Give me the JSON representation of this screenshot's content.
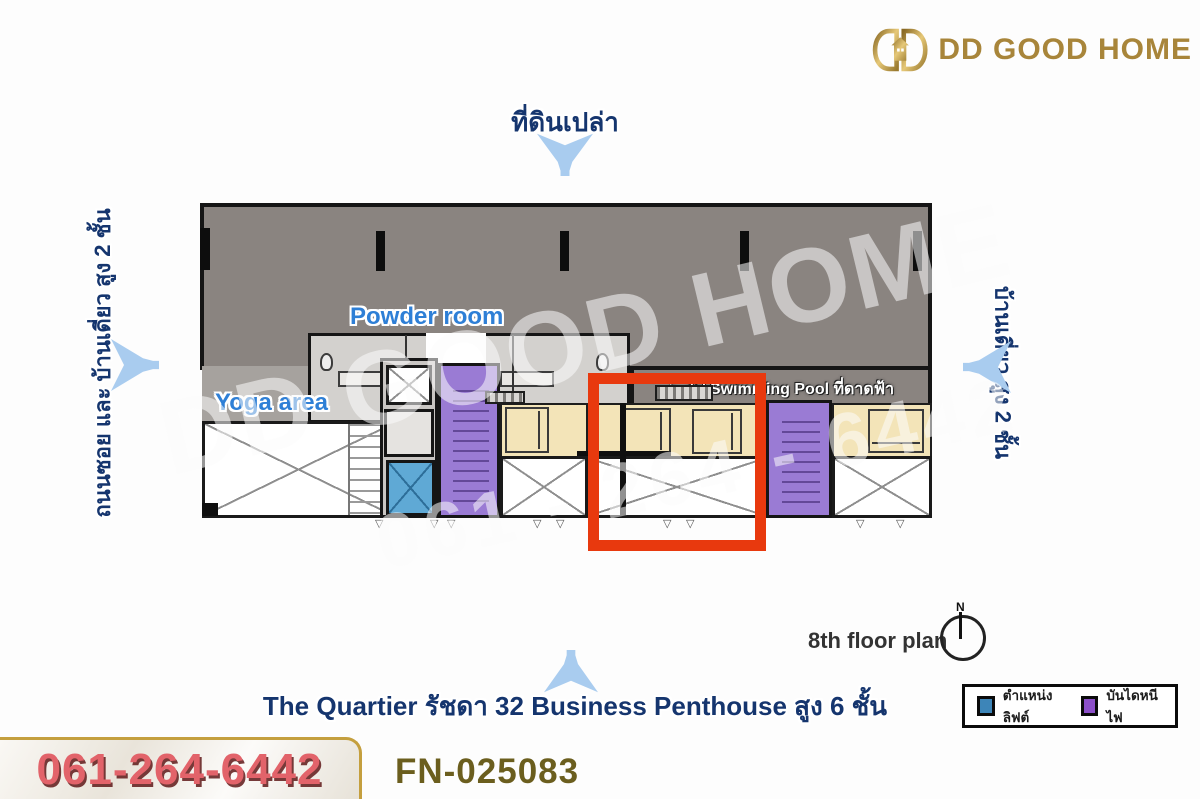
{
  "brand": {
    "name": "DD GOOD HOME"
  },
  "surroundings": {
    "top_label": "ที่ดินเปล่า",
    "left_label": "ถนนซอย และ บ้านเดี่ยว สูง 2 ชั้น",
    "right_label": "บ้านเดี่ยว สูง 2 ชั้น"
  },
  "plan": {
    "powder_room_label": "Powder room",
    "yoga_area_label": "Yoga area",
    "pool_label": "ไป Swimming Pool ที่ดาดฟ้า",
    "pool_arrow_glyph": "➤",
    "floor_plan_label": "8th floor plan",
    "compass_north_label": "N",
    "door_mark_glyph": "▽"
  },
  "watermark": {
    "line1": "DD GOOD HOME",
    "line2": "061 - 264 - 6442"
  },
  "project_title": "The Quartier รัชดา 32 Business Penthouse สูง 6 ชั้น",
  "legend": {
    "items": [
      {
        "label": "ตำแหน่งลิฟต์",
        "color": "#3d85b8"
      },
      {
        "label": "บันไดหนีไฟ",
        "color": "#8c4fc9"
      }
    ]
  },
  "footer": {
    "phone": "061-264-6442",
    "listing_code": "FN-025083"
  },
  "colors": {
    "accent_red": "#e8390e",
    "elevator_blue": "#5fa9d5",
    "stair_purple": "#9a7bd4",
    "room_cream": "#f3e4b8",
    "plan_gray": "#8a8480",
    "brand_gold": "#a8853a",
    "label_navy": "#15356e",
    "label_blue": "#2e7fd6",
    "arrow_blue": "#a9ccef",
    "phone_red": "#e2636a"
  }
}
